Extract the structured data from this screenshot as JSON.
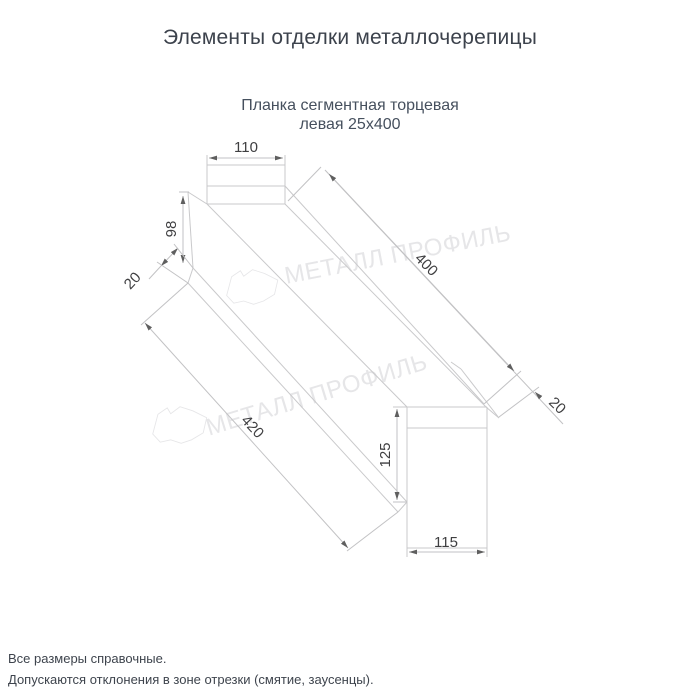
{
  "header": {
    "title": "Элементы отделки металлочерепицы"
  },
  "product": {
    "name_line1": "Планка сегментная торцевая",
    "name_line2": "левая 25х400"
  },
  "drawing": {
    "dim_top_width": "110",
    "dim_web_height": "98",
    "dim_hem_top": "20",
    "dim_length_top": "400",
    "dim_hem_bottom": "20",
    "dim_length_bottom": "420",
    "dim_end_height": "125",
    "dim_end_width": "115"
  },
  "watermark": {
    "brand": "МЕТАЛЛ ПРОФИЛЬ"
  },
  "footer": {
    "note1": "Все размеры справочные.",
    "note2": "Допускаются отклонения в зоне отрезки (смятие, заусенцы)."
  },
  "colors": {
    "title_text": "#3c424c",
    "drawing_line": "#c9c9cb",
    "dimension_text": "#3f3f41",
    "watermark": "#e6e6e8"
  }
}
